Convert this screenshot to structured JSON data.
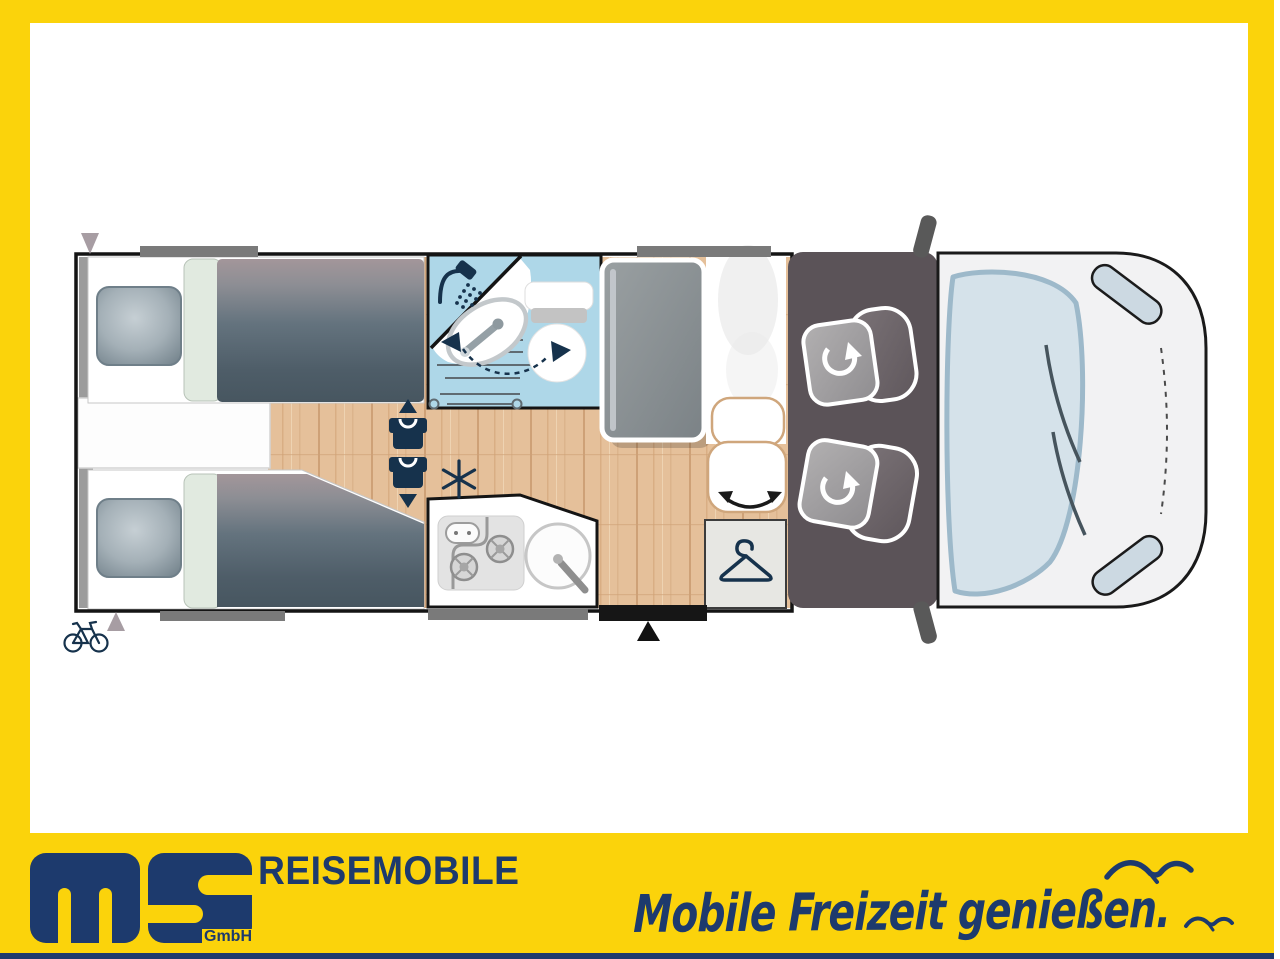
{
  "page": {
    "width": 1280,
    "height": 959
  },
  "banner": {
    "logo": {
      "letters": "ms",
      "suffix": "GmbH"
    },
    "brand_title": "REISEMOBILE",
    "slogan": "Mobile Freizeit genießen."
  },
  "colors": {
    "frame-yellow": "#FBD30B",
    "brand-navy": "#1D3A6D",
    "icon-navy": "#16324C",
    "wall-black": "#141414",
    "bath-blue": "#AED7E8",
    "wood-base": "#E5C09A",
    "cab-floor": "#5B5358",
    "vehicle-body": "#F2F2F3",
    "windshield": "#D5E2EA",
    "windshield-rim": "#9DB9CA",
    "duvet-dark": "#475660",
    "duvet-light": "#A3969A",
    "mint": "#E1EAE0",
    "bar-gray": "#7A7A7A",
    "marker-gray": "#A79DA3",
    "tan-outline": "#CFA67C",
    "wardrobe-gray": "#E7E7E3",
    "seat-gray": "#A3A1A2",
    "seat-back": "#6B6368"
  },
  "floorplan": {
    "type": "motorhome-top-view-layout",
    "icons": {
      "shower-icon": "shower head with spray drops",
      "swivel-basin-arrow-icon": "dashed arc with navy arrowheads (swivel washbasin)",
      "snowflake-icon": "fridge / freezer snowflake",
      "travel-seat-icons": "two belted-seat shirts with up and down arrows",
      "seat-rotate-icons": "white circular rotation arrows on both cab seats",
      "bench-swivel-icon": "curved double-headed arrow on bench seat",
      "hanger-icon": "clothes hanger in wardrobe",
      "bike-rack-icon": "bicycle at rear",
      "entry-door-marker-icon": "black triangle at entry door",
      "rear-marker-icons": "gray triangles at rear corners",
      "seagull-icons": "two seagulls in banner"
    }
  }
}
